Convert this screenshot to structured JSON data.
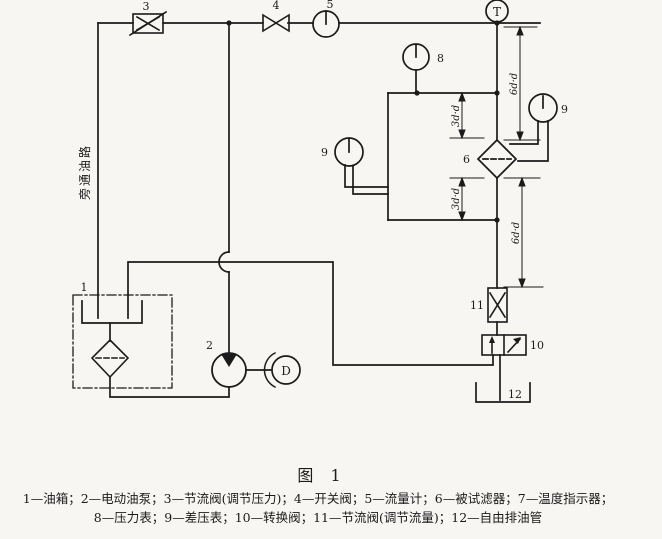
{
  "figure": {
    "caption_title": "图 1",
    "legend_line1": "1—油箱；2—电动油泵；3—节流阀(调节压力)；4—开关阀；5—流量计；6—被试滤器；7—温度指示器；",
    "legend_line2": "8—压力表；9—差压表；10—转换阀；11—节流阀(调节流量)；12—自由排油管"
  },
  "diagram": {
    "bypass_line_label": "旁通油路",
    "temperature_indicator_letter": "T",
    "motor_letter": "D",
    "labels": {
      "tank": "1",
      "pump": "2",
      "throttle_pressure_valve": "3",
      "switch_valve": "4",
      "flow_meter": "5",
      "test_filter": "6",
      "pressure_gauge": "8",
      "diff_gauge_left": "9",
      "diff_gauge_right": "9",
      "switching_valve": "10",
      "throttle_flow_valve": "11",
      "drain_tank": "12"
    },
    "dimensions": {
      "upstream_near": "3d·d",
      "upstream_far": "6d·d",
      "downstream_near": "3d·d",
      "downstream_far": "6d·d"
    },
    "colors": {
      "ink": "#1b1b1b",
      "paper": "#f7f6f2"
    }
  }
}
